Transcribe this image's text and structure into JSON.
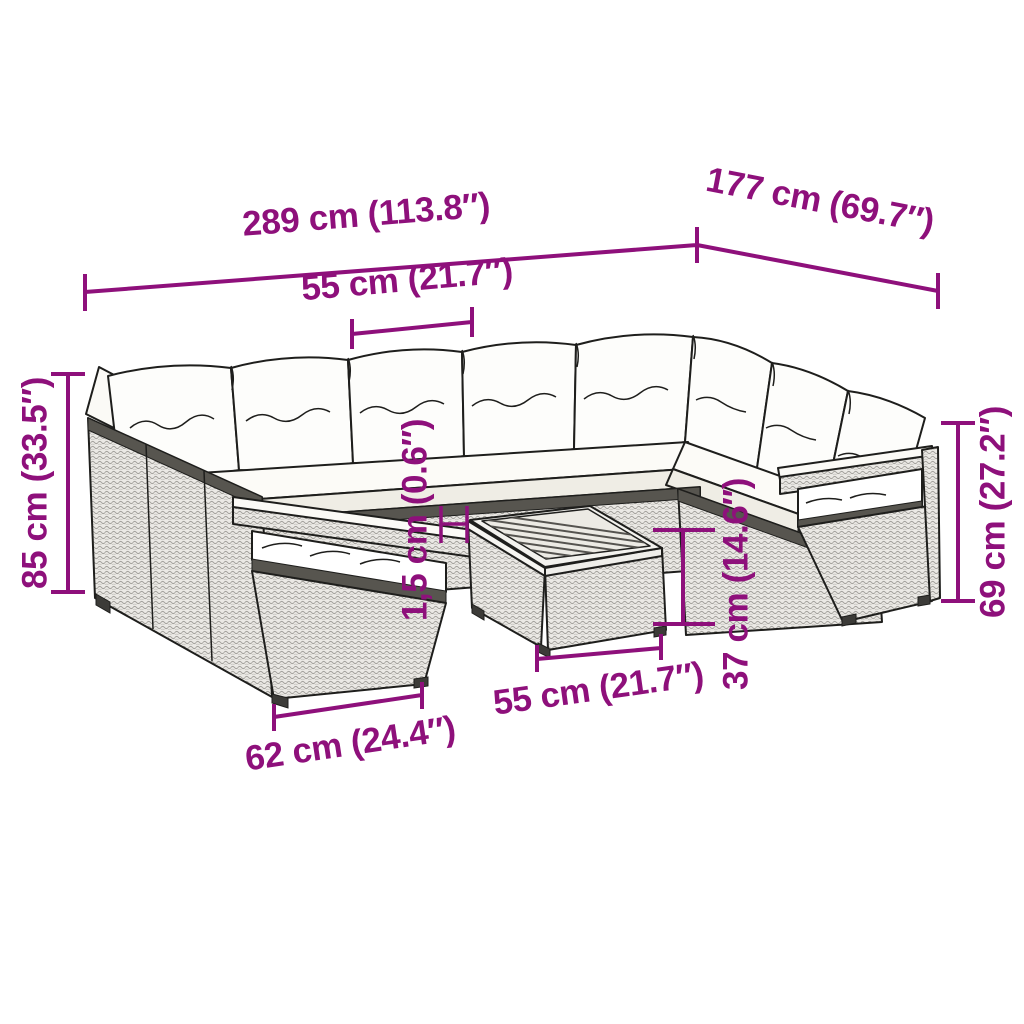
{
  "diagram": {
    "description": "Dimension diagram of an L-shaped poly rattan garden lounge set with white back and seat cushions, two low end armrests and a square coffee table with slatted wooden top",
    "background_color": "#ffffff",
    "accent_color": "#8e107b",
    "outline_color": "#1e1e1c"
  },
  "dims": {
    "overall_width": "289 cm (113.8″)",
    "overall_depth": "177 cm (69.7″)",
    "seat_width": "55 cm (21.7″)",
    "back_height": "85 cm (33.5″)",
    "right_height": "69 cm (27.2″)",
    "tabletop_thickness": "1,5 cm (0.6″)",
    "table_height": "37 cm (14.6″)",
    "table_width": "55 cm (21.7″)",
    "end_section_width": "62 cm (24.4″)"
  }
}
